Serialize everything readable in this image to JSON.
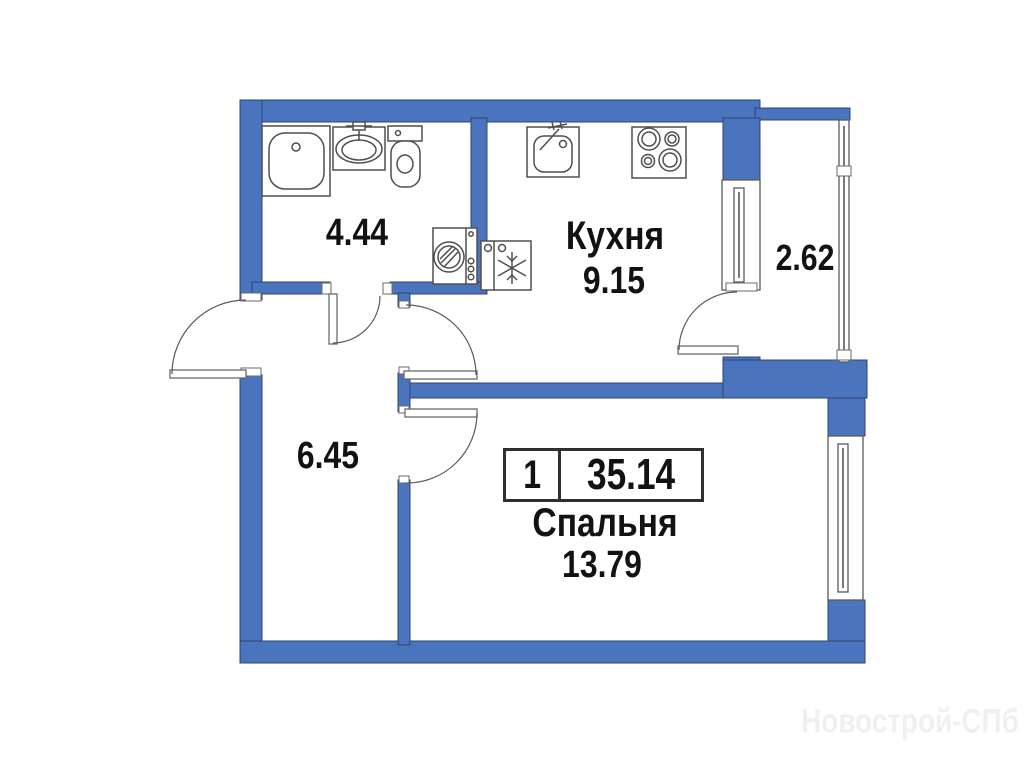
{
  "plan": {
    "type_badge": {
      "rooms_count": "1",
      "total_area": "35.14"
    },
    "rooms": {
      "bathroom": {
        "area": "4.44"
      },
      "kitchen": {
        "name": "Кухня",
        "area": "9.15"
      },
      "loggia": {
        "area": "2.62"
      },
      "hallway": {
        "area": "6.45"
      },
      "bedroom": {
        "name": "Спальня",
        "area": "13.79"
      }
    },
    "watermark": "Новострой-СПб",
    "colors": {
      "wall": "#4a74bd",
      "wall_outline": "#2c4470",
      "fixture_stroke": "#4f4f4f",
      "text": "#121212",
      "badge_border": "#2f2f2f",
      "watermark": "#f0f0f0"
    }
  }
}
